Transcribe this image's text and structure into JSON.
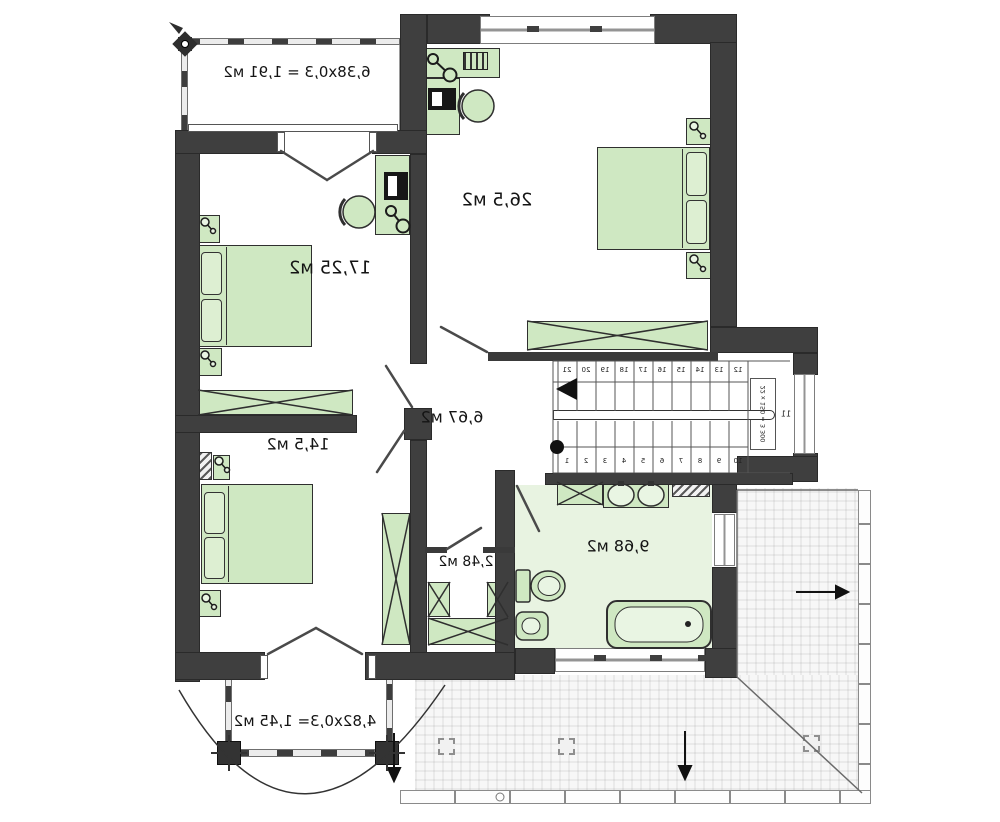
{
  "plan": {
    "rooms": [
      {
        "id": "balcony-top",
        "label": "6,38x0,3 = 1,91 м2"
      },
      {
        "id": "bedroom-top",
        "label": "26,5 м2"
      },
      {
        "id": "bedroom-left",
        "label": "17,25 м2"
      },
      {
        "id": "hallway",
        "label": "6,67 м2"
      },
      {
        "id": "bedroom-bottom",
        "label": "14,5 м2"
      },
      {
        "id": "closet",
        "label": "2,48 м2"
      },
      {
        "id": "bathroom",
        "label": "9,68 м2"
      },
      {
        "id": "balcony-bottom",
        "label": "4,82x0,3= 1,45 м2"
      }
    ],
    "stairs": {
      "note": "22 x 150 = 3 300",
      "landing_number": "11",
      "upper_step_numbers": [
        "21",
        "20",
        "19",
        "18",
        "17",
        "16",
        "15",
        "14",
        "13",
        "12"
      ],
      "lower_step_numbers": [
        "1",
        "2",
        "3",
        "4",
        "5",
        "6",
        "7",
        "8",
        "9",
        "10"
      ]
    },
    "colors": {
      "wall": "#3f3f3f",
      "furniture_fill": "#cfe8c2",
      "bathroom_floor": "#e8f3e1",
      "text": "#141414"
    },
    "orientation": "mirrored"
  }
}
